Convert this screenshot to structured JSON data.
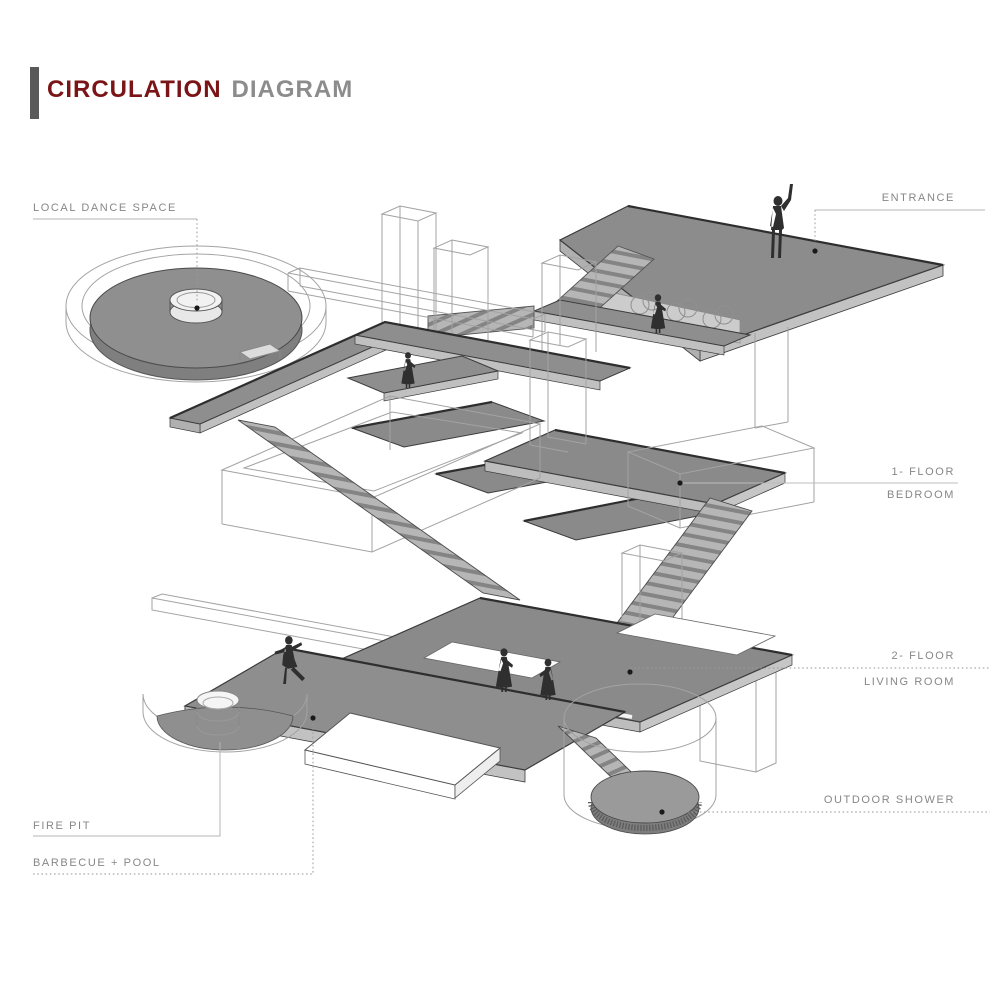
{
  "title": {
    "accent": "CIRCULATION",
    "rest": "DIAGRAM"
  },
  "labels": {
    "local_dance_space": "LOCAL DANCE SPACE",
    "entrance": "ENTRANCE",
    "floor1": {
      "line1": "1- FLOOR",
      "line2": "BEDROOM"
    },
    "floor2": {
      "line1": "2- FLOOR",
      "line2": "LIVING ROOM"
    },
    "outdoor_shower": "OUTDOOR SHOWER",
    "fire_pit": "FIRE PIT",
    "barbecue_pool": "BARBECUE + POOL"
  },
  "colors": {
    "title_accent": "#7a1416",
    "title_muted": "#8c8c8c",
    "label_text": "#878787",
    "plate_gray": "#8e8e8e",
    "plate_side": "#c2c2c2",
    "wireframe": "#a3a3a3",
    "figure": "#2f2f2f",
    "leader_dot": "#1a1a1a"
  },
  "figures": [
    "man-arm-raised-entrance",
    "woman-entrance-landing",
    "woman-floor1-platform",
    "dancer-barbecue-terrace",
    "woman-living-room-violin",
    "woman-living-room"
  ]
}
